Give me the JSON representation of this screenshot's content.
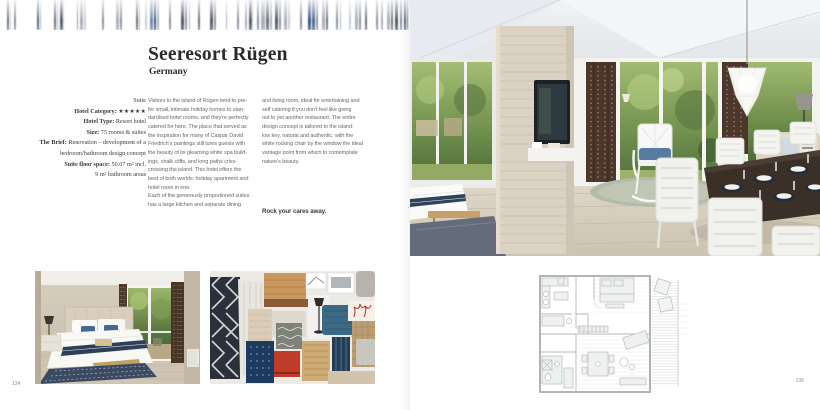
{
  "accent_colors": {
    "navy": "#31435c",
    "wood": "#dbd2c4",
    "curtain_brown": "#4c372a",
    "foliage_green": "#6f8f4c"
  },
  "left_page": {
    "page_number": "134",
    "title": "Seeresort Rügen",
    "subtitle": "Germany",
    "meta_lines": [
      {
        "bold": "",
        "rest": "Suite"
      },
      {
        "bold": "Hotel Category:",
        "rest": " ★★★★★"
      },
      {
        "bold": "Hotel Type:",
        "rest": " Resort hotel"
      },
      {
        "bold": "Size:",
        "rest": " 75 rooms & suites"
      },
      {
        "bold": "The Brief:",
        "rest": " Renovation – development of a"
      },
      {
        "bold": "",
        "rest": "bedroom/bathroom design concept"
      },
      {
        "bold": "Suite floor space:",
        "rest": " 50.07 m² incl."
      },
      {
        "bold": "",
        "rest": "9 m² bathroom areas"
      }
    ],
    "body_col1_lines": [
      "Visitors to the island of Rügen tend to pre-",
      "fer small, intimate holiday homes to stan-",
      "dardised hotel rooms, and they're perfectly",
      "catered for here. The place that served as",
      "the inspiration for many of Caspar David",
      "Friedrich's paintings still lures guests with",
      "the beauty of its gleaming white spa build-",
      "ings, chalk cliffs, and long paths criss-",
      "crossing the island. This hotel offers the",
      "best of both worlds: holiday apartment and",
      "hotel room in one.",
      "Each of the generously proportioned suites",
      "has a large kitchen and separate dining"
    ],
    "body_col2_lines": [
      "and living room, ideal for entertaining and",
      "self catering if you don't feel like going",
      "out to yet another restaurant. The entire",
      "design concept is tailored to the island:",
      "low key, natural and authentic, with the",
      "white rocking chair by the window the ideal",
      "vantage point from which to contemplate",
      "nature's beauty."
    ],
    "tagline": "Rock your cares away."
  },
  "right_page": {
    "page_number": "135"
  }
}
